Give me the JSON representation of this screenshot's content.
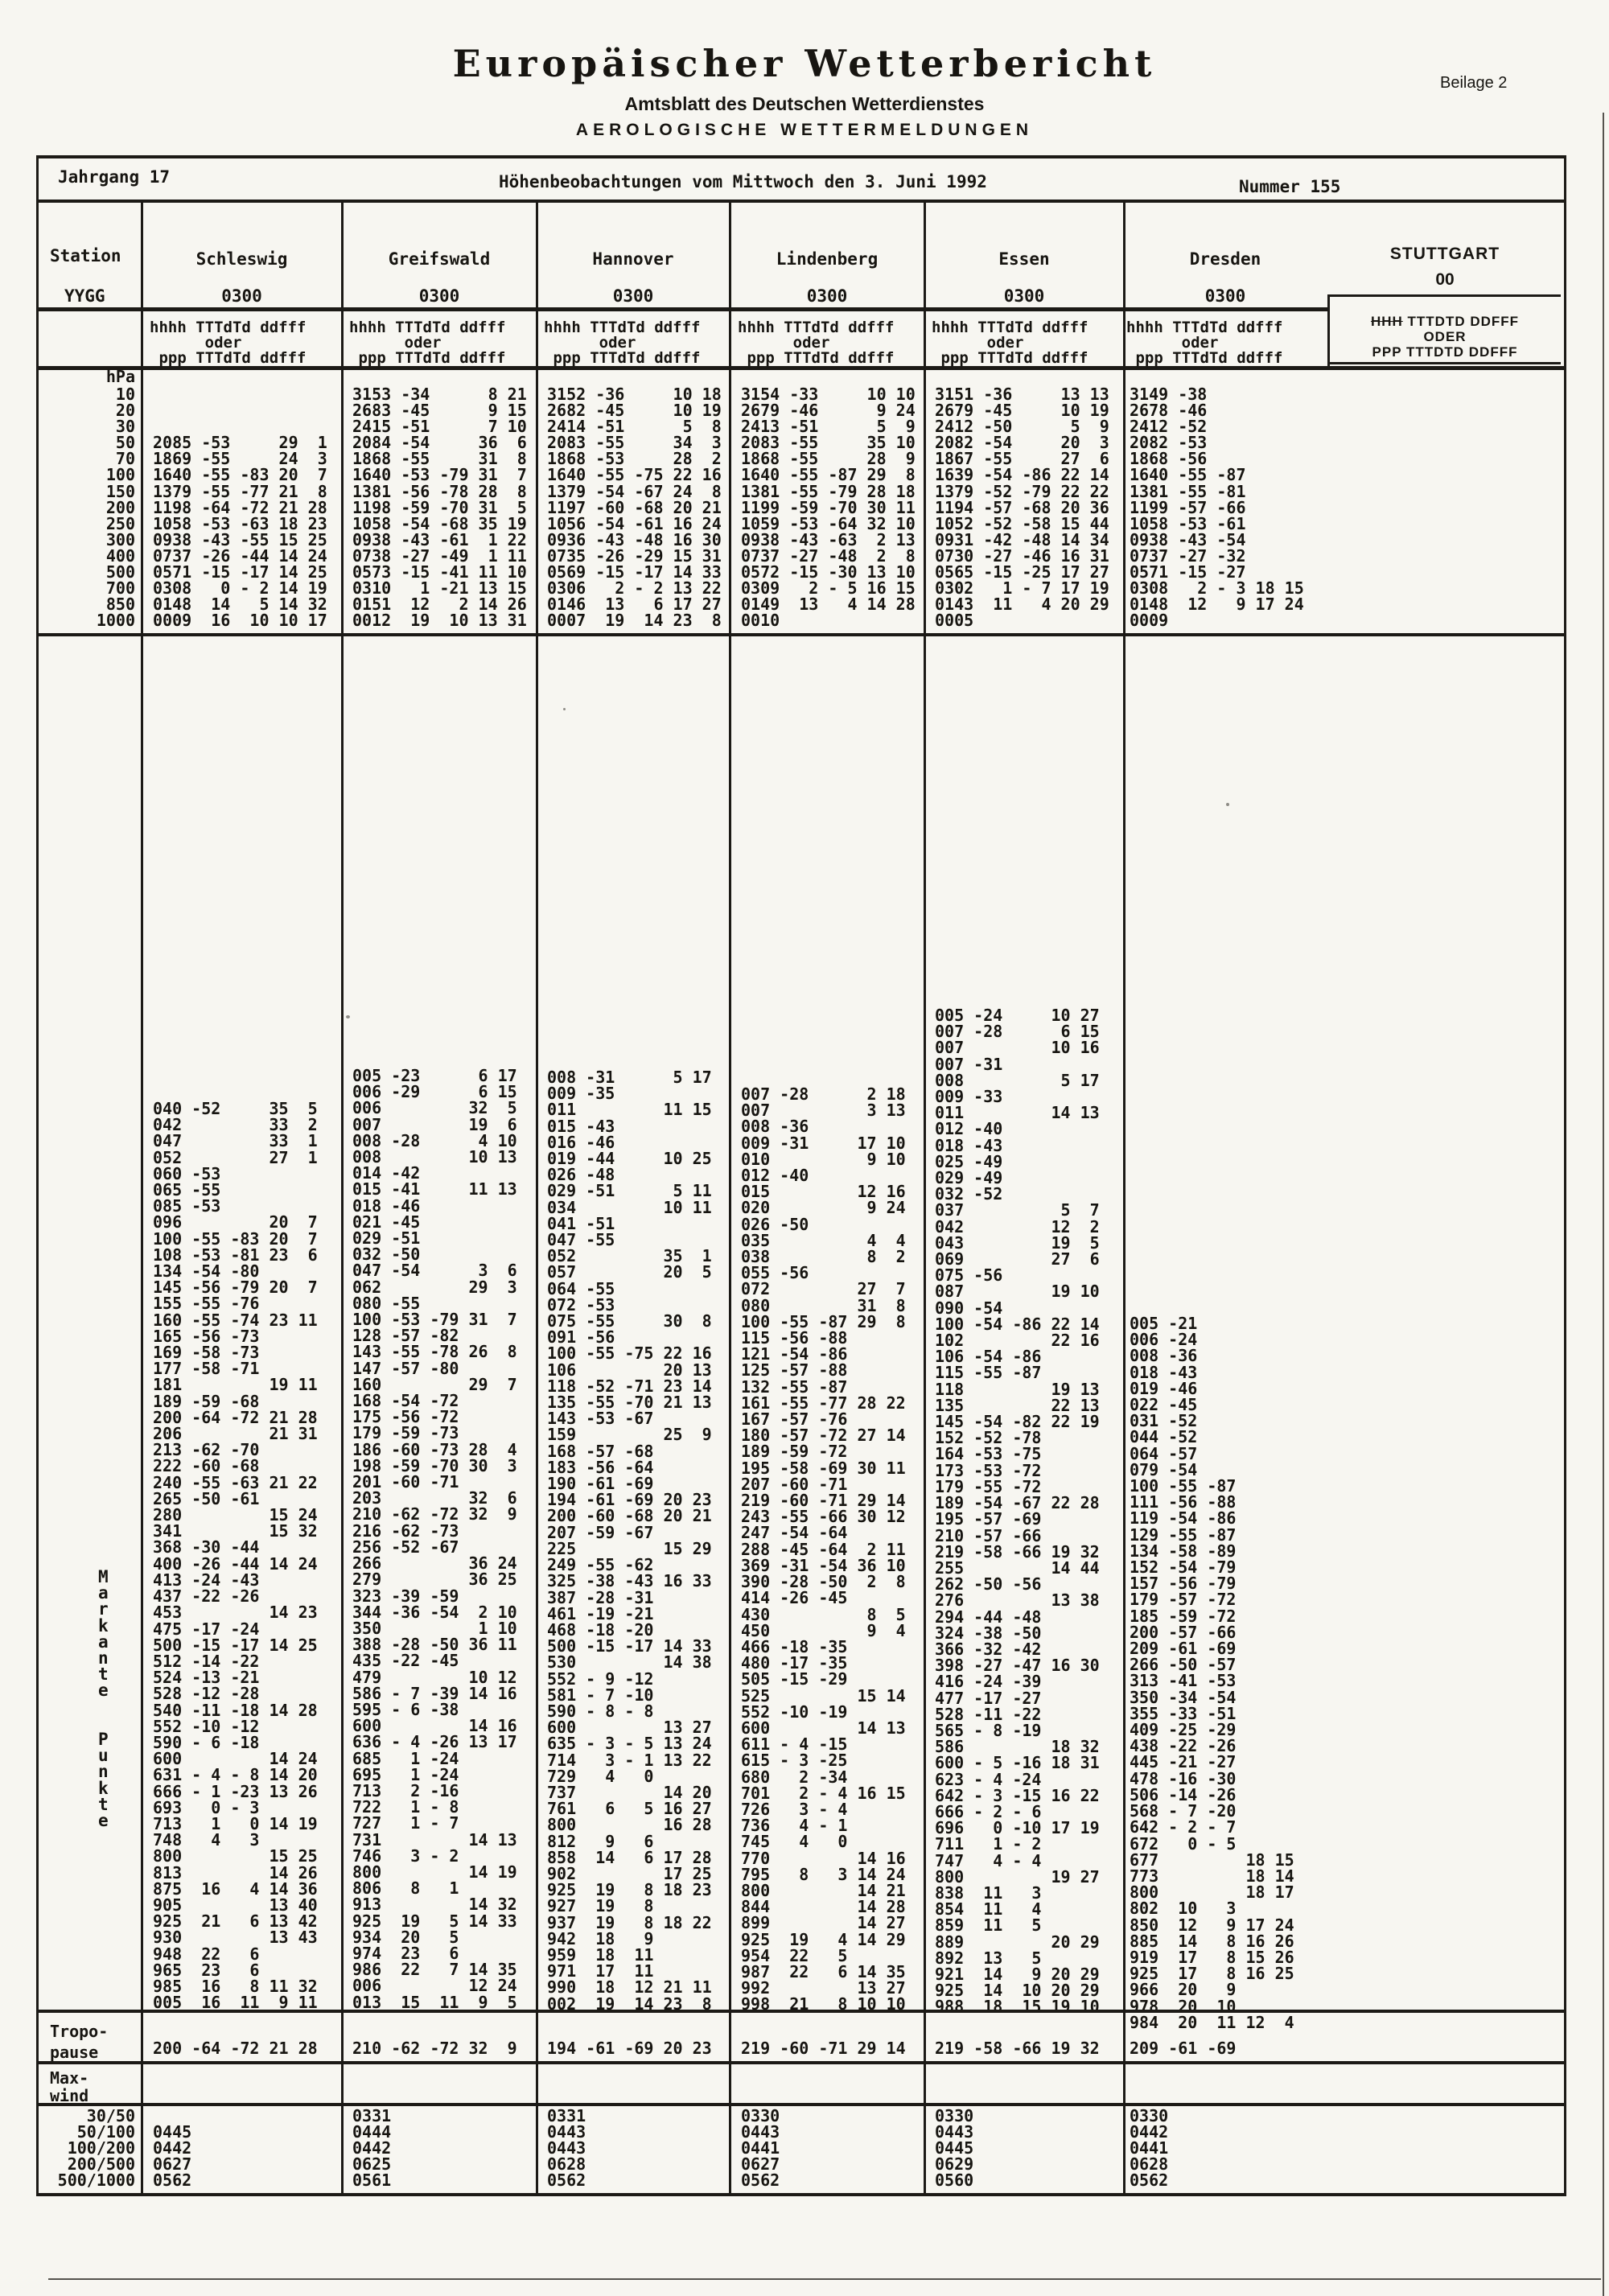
{
  "page": {
    "title": "Europäischer Wetterbericht",
    "subtitle": "Amtsblatt des Deutschen Wetterdienstes",
    "section": "AEROLOGISCHE WETTERMELDUNGEN",
    "beilage": "Beilage 2"
  },
  "masthead": {
    "jahrgang": "Jahrgang 17",
    "observation": "Höhenbeobachtungen  vom Mittwoch    den 3. Juni     1992",
    "nummer": "Nummer 155"
  },
  "labels": {
    "station": "Station",
    "yygg": "YYGG",
    "unit": "hPa",
    "format_lines": [
      "hhhh TTTdTd ddfff",
      "      oder",
      " ppp TTTdTd ddfff"
    ],
    "side_vertical": [
      "M",
      "a",
      "r",
      "k",
      "a",
      "n",
      "t",
      "e",
      "",
      "",
      "P",
      "u",
      "n",
      "k",
      "t",
      "e"
    ],
    "tropopause": [
      "Tropo-",
      "pause"
    ],
    "maxwind": [
      "Max-",
      "wind"
    ],
    "maxwind_ranges": [
      "30/50",
      "50/100",
      "100/200",
      "200/500",
      "500/1000"
    ],
    "pressure_levels": [
      "10",
      "20",
      "30",
      "50",
      "70",
      "100",
      "150",
      "200",
      "250",
      "300",
      "400",
      "500",
      "700",
      "850",
      "1000"
    ]
  },
  "stuttgart": {
    "name": "STUTTGART",
    "time": "00",
    "stamp_l1a": "HHH",
    "stamp_l1b": " TTTDTD DDFFF",
    "stamp_l2": "ODER",
    "stamp_l3": "PPP TTTDTD DDFFF"
  },
  "stations": [
    {
      "name": "Schleswig",
      "time": "0300",
      "pressure_lines": [
        "",
        "",
        "",
        "2085 -53     29  1",
        "1869 -55     24  3",
        "1640 -55 -83 20  7",
        "1379 -55 -77 21  8",
        "1198 -64 -72 21 28",
        "1058 -53 -63 18 23",
        "0938 -43 -55 15 25",
        "0737 -26 -44 14 24",
        "0571 -15 -17 14 25",
        "0308   0 - 2 14 19",
        "0148  14   5 14 32",
        "0009  16  10 10 17"
      ],
      "sig_lines": [
        "040 -52     35  5",
        "042         33  2",
        "047         33  1",
        "052         27  1",
        "060 -53",
        "065 -55",
        "085 -53",
        "096         20  7",
        "100 -55 -83 20  7",
        "108 -53 -81 23  6",
        "134 -54 -80",
        "145 -56 -79 20  7",
        "155 -55 -76",
        "160 -55 -74 23 11",
        "165 -56 -73",
        "169 -58 -73",
        "177 -58 -71",
        "181         19 11",
        "189 -59 -68",
        "200 -64 -72 21 28",
        "206         21 31",
        "213 -62 -70",
        "222 -60 -68",
        "240 -55 -63 21 22",
        "265 -50 -61",
        "280         15 24",
        "341         15 32",
        "368 -30 -44",
        "400 -26 -44 14 24",
        "413 -24 -43",
        "437 -22 -26",
        "453         14 23",
        "475 -17 -24",
        "500 -15 -17 14 25",
        "512 -14 -22",
        "524 -13 -21",
        "528 -12 -28",
        "540 -11 -18 14 28",
        "552 -10 -12",
        "590 - 6 -18",
        "600         14 24",
        "631 - 4 - 8 14 20",
        "666 - 1 -23 13 26",
        "693   0 - 3",
        "713   1   0 14 19",
        "748   4   3",
        "800         15 25",
        "813         14 26",
        "875  16   4 14 36",
        "905         13 40",
        "925  21   6 13 42",
        "930         13 43",
        "948  22   6",
        "965  23   6",
        "985  16   8 11 32",
        "005  16  11  9 11"
      ],
      "tropopause": "200 -64 -72 21 28",
      "maxwind": [
        "",
        "0445",
        "0442",
        "0627",
        "0562"
      ]
    },
    {
      "name": "Greifswald",
      "time": "0300",
      "pressure_lines": [
        "3153 -34      8 21",
        "2683 -45      9 15",
        "2415 -51      7 10",
        "2084 -54     36  6",
        "1868 -55     31  8",
        "1640 -53 -79 31  7",
        "1381 -56 -78 28  8",
        "1198 -59 -70 31  5",
        "1058 -54 -68 35 19",
        "0938 -43 -61  1 22",
        "0738 -27 -49  1 11",
        "0573 -15 -41 11 10",
        "0310   1 -21 13 15",
        "0151  12   2 14 26",
        "0012  19  10 13 31"
      ],
      "sig_lines": [
        "005 -23      6 17",
        "006 -29      6 15",
        "006         32  5",
        "007         19  6",
        "008 -28      4 10",
        "008         10 13",
        "014 -42",
        "015 -41     11 13",
        "018 -46",
        "021 -45",
        "029 -51",
        "032 -50",
        "047 -54      3  6",
        "062         29  3",
        "080 -55",
        "100 -53 -79 31  7",
        "128 -57 -82",
        "143 -55 -78 26  8",
        "147 -57 -80",
        "160         29  7",
        "168 -54 -72",
        "175 -56 -72",
        "179 -59 -73",
        "186 -60 -73 28  4",
        "198 -59 -70 30  3",
        "201 -60 -71",
        "203         32  6",
        "210 -62 -72 32  9",
        "216 -62 -73",
        "256 -52 -67",
        "266         36 24",
        "279         36 25",
        "323 -39 -59",
        "344 -36 -54  2 10",
        "350          1 10",
        "388 -28 -50 36 11",
        "435 -22 -45",
        "479         10 12",
        "586 - 7 -39 14 16",
        "595 - 6 -38",
        "600         14 16",
        "636 - 4 -26 13 17",
        "685   1 -24",
        "695   1 -24",
        "713   2 -16",
        "722   1 - 8",
        "727   1 - 7",
        "731         14 13",
        "746   3 - 2",
        "800         14 19",
        "806   8   1",
        "913         14 32",
        "925  19   5 14 33",
        "934  20   5",
        "974  23   6",
        "986  22   7 14 35",
        "006         12 24",
        "013  15  11  9  5"
      ],
      "tropopause": "210 -62 -72 32  9",
      "maxwind": [
        "0331",
        "0444",
        "0442",
        "0625",
        "0561"
      ]
    },
    {
      "name": "Hannover",
      "time": "0300",
      "pressure_lines": [
        "3152 -36     10 18",
        "2682 -45     10 19",
        "2414 -51      5  8",
        "2083 -55     34  3",
        "1868 -53     28  2",
        "1640 -55 -75 22 16",
        "1379 -54 -67 24  8",
        "1197 -60 -68 20 21",
        "1056 -54 -61 16 24",
        "0936 -43 -48 16 30",
        "0735 -26 -29 15 31",
        "0569 -15 -17 14 33",
        "0306   2 - 2 13 22",
        "0146  13   6 17 27",
        "0007  19  14 23  8"
      ],
      "sig_lines": [
        "008 -31      5 17",
        "009 -35",
        "011         11 15",
        "015 -43",
        "016 -46",
        "019 -44     10 25",
        "026 -48",
        "029 -51      5 11",
        "034         10 11",
        "041 -51",
        "047 -55",
        "052         35  1",
        "057         20  5",
        "064 -55",
        "072 -53",
        "075 -55     30  8",
        "091 -56",
        "100 -55 -75 22 16",
        "106         20 13",
        "118 -52 -71 23 14",
        "135 -55 -70 21 13",
        "143 -53 -67",
        "159         25  9",
        "168 -57 -68",
        "183 -56 -64",
        "190 -61 -69",
        "194 -61 -69 20 23",
        "200 -60 -68 20 21",
        "207 -59 -67",
        "225         15 29",
        "249 -55 -62",
        "325 -38 -43 16 33",
        "387 -28 -31",
        "461 -19 -21",
        "468 -18 -20",
        "500 -15 -17 14 33",
        "530         14 38",
        "552 - 9 -12",
        "581 - 7 -10",
        "590 - 8 - 8",
        "600         13 27",
        "635 - 3 - 5 13 24",
        "714   3 - 1 13 22",
        "729   4   0",
        "737         14 20",
        "761   6   5 16 27",
        "800         16 28",
        "812   9   6",
        "858  14   6 17 28",
        "902         17 25",
        "925  19   8 18 23",
        "927  19   8",
        "937  19   8 18 22",
        "942  18   9",
        "959  18  11",
        "971  17  11",
        "990  18  12 21 11",
        "002  19  14 23  8"
      ],
      "tropopause": "194 -61 -69 20 23",
      "maxwind": [
        "0331",
        "0443",
        "0443",
        "0628",
        "0562"
      ]
    },
    {
      "name": "Lindenberg",
      "time": "0300",
      "pressure_lines": [
        "3154 -33     10 10",
        "2679 -46      9 24",
        "2413 -51      5  9",
        "2083 -55     35 10",
        "1868 -55     28  9",
        "1640 -55 -87 29  8",
        "1381 -55 -79 28 18",
        "1199 -59 -70 30 11",
        "1059 -53 -64 32 10",
        "0938 -43 -63  2 13",
        "0737 -27 -48  2  8",
        "0572 -15 -30 13 10",
        "0309   2 - 5 16 15",
        "0149  13   4 14 28",
        "0010"
      ],
      "sig_lines": [
        "007 -28      2 18",
        "007          3 13",
        "008 -36",
        "009 -31     17 10",
        "010          9 10",
        "012 -40",
        "015         12 16",
        "020          9 24",
        "026 -50",
        "035          4  4",
        "038          8  2",
        "055 -56",
        "072         27  7",
        "080         31  8",
        "100 -55 -87 29  8",
        "115 -56 -88",
        "121 -54 -86",
        "125 -57 -88",
        "132 -55 -87",
        "161 -55 -77 28 22",
        "167 -57 -76",
        "180 -57 -72 27 14",
        "189 -59 -72",
        "195 -58 -69 30 11",
        "207 -60 -71",
        "219 -60 -71 29 14",
        "243 -55 -66 30 12",
        "247 -54 -64",
        "288 -45 -64  2 11",
        "369 -31 -54 36 10",
        "390 -28 -50  2  8",
        "414 -26 -45",
        "430          8  5",
        "450          9  4",
        "466 -18 -35",
        "480 -17 -35",
        "505 -15 -29",
        "525         15 14",
        "552 -10 -19",
        "600         14 13",
        "611 - 4 -15",
        "615 - 3 -25",
        "680   2 -34",
        "701   2 - 4 16 15",
        "726   3 - 4",
        "736   4 - 1",
        "745   4   0",
        "770         14 16",
        "795   8   3 14 24",
        "800         14 21",
        "844         14 28",
        "899         14 27",
        "925  19   4 14 29",
        "954  22   5",
        "987  22   6 14 35",
        "992         13 27",
        "998  21   8 10 10"
      ],
      "tropopause": "219 -60 -71 29 14",
      "maxwind": [
        "0330",
        "0443",
        "0441",
        "0627",
        "0562"
      ]
    },
    {
      "name": "Essen",
      "time": "0300",
      "pressure_lines": [
        "3151 -36     13 13",
        "2679 -45     10 19",
        "2412 -50      5  9",
        "2082 -54     20  3",
        "1867 -55     27  6",
        "1639 -54 -86 22 14",
        "1379 -52 -79 22 22",
        "1194 -57 -68 20 36",
        "1052 -52 -58 15 44",
        "0931 -42 -48 14 34",
        "0730 -27 -46 16 31",
        "0565 -15 -25 17 27",
        "0302   1 - 7 17 19",
        "0143  11   4 20 29",
        "0005"
      ],
      "sig_lines": [
        "005 -24     10 27",
        "007 -28      6 15",
        "007         10 16",
        "007 -31",
        "008          5 17",
        "009 -33",
        "011         14 13",
        "012 -40",
        "018 -43",
        "025 -49",
        "029 -49",
        "032 -52",
        "037          5  7",
        "042         12  2",
        "043         19  5",
        "069         27  6",
        "075 -56",
        "087         19 10",
        "090 -54",
        "100 -54 -86 22 14",
        "102         22 16",
        "106 -54 -86",
        "115 -55 -87",
        "118         19 13",
        "135         22 13",
        "145 -54 -82 22 19",
        "152 -52 -78",
        "164 -53 -75",
        "173 -53 -72",
        "179 -55 -72",
        "189 -54 -67 22 28",
        "195 -57 -69",
        "210 -57 -66",
        "219 -58 -66 19 32",
        "255         14 44",
        "262 -50 -56",
        "276         13 38",
        "294 -44 -48",
        "324 -38 -50",
        "366 -32 -42",
        "398 -27 -47 16 30",
        "416 -24 -39",
        "477 -17 -27",
        "528 -11 -22",
        "565 - 8 -19",
        "586         18 32",
        "600 - 5 -16 18 31",
        "623 - 4 -24",
        "642 - 3 -15 16 22",
        "666 - 2 - 6",
        "696   0 -10 17 19",
        "711   1 - 2",
        "747   4 - 4",
        "800         19 27",
        "838  11   3",
        "854  11   4",
        "859  11   5",
        "889         20 29",
        "892  13   5",
        "921  14   9 20 29",
        "925  14  10 20 29",
        "988  18  15 19 10"
      ],
      "tropopause": "219 -58 -66 19 32",
      "maxwind": [
        "0330",
        "0443",
        "0445",
        "0629",
        "0560"
      ]
    },
    {
      "name": "Dresden",
      "time": "0300",
      "pressure_lines": [
        "3149 -38",
        "2678 -46",
        "2412 -52",
        "2082 -53",
        "1868 -56",
        "1640 -55 -87",
        "1381 -55 -81",
        "1199 -57 -66",
        "1058 -53 -61",
        "0938 -43 -54",
        "0737 -27 -32",
        "0571 -15 -27",
        "0308   2 - 3 18 15",
        "0148  12   9 17 24",
        "0009"
      ],
      "sig_lines": [
        "005 -21",
        "006 -24",
        "008 -36",
        "018 -43",
        "019 -46",
        "022 -45",
        "031 -52",
        "044 -52",
        "064 -57",
        "079 -54",
        "100 -55 -87",
        "111 -56 -88",
        "119 -54 -86",
        "129 -55 -87",
        "134 -58 -89",
        "152 -54 -79",
        "157 -56 -79",
        "179 -57 -72",
        "185 -59 -72",
        "200 -57 -66",
        "209 -61 -69",
        "266 -50 -57",
        "313 -41 -53",
        "350 -34 -54",
        "355 -33 -51",
        "409 -25 -29",
        "438 -22 -26",
        "445 -21 -27",
        "478 -16 -30",
        "506 -14 -26",
        "568 - 7 -20",
        "642 - 2 - 7",
        "672   0 - 5",
        "677         18 15",
        "773         18 14",
        "800         18 17",
        "802  10   3",
        "850  12   9 17 24",
        "885  14   8 16 26",
        "919  17   8 15 26",
        "925  17   8 16 25",
        "966  20   9",
        "978  20  10",
        "984  20  11 12  4"
      ],
      "tropopause": "209 -61 -69",
      "maxwind": [
        "0330",
        "0442",
        "0441",
        "0628",
        "0562"
      ]
    }
  ]
}
